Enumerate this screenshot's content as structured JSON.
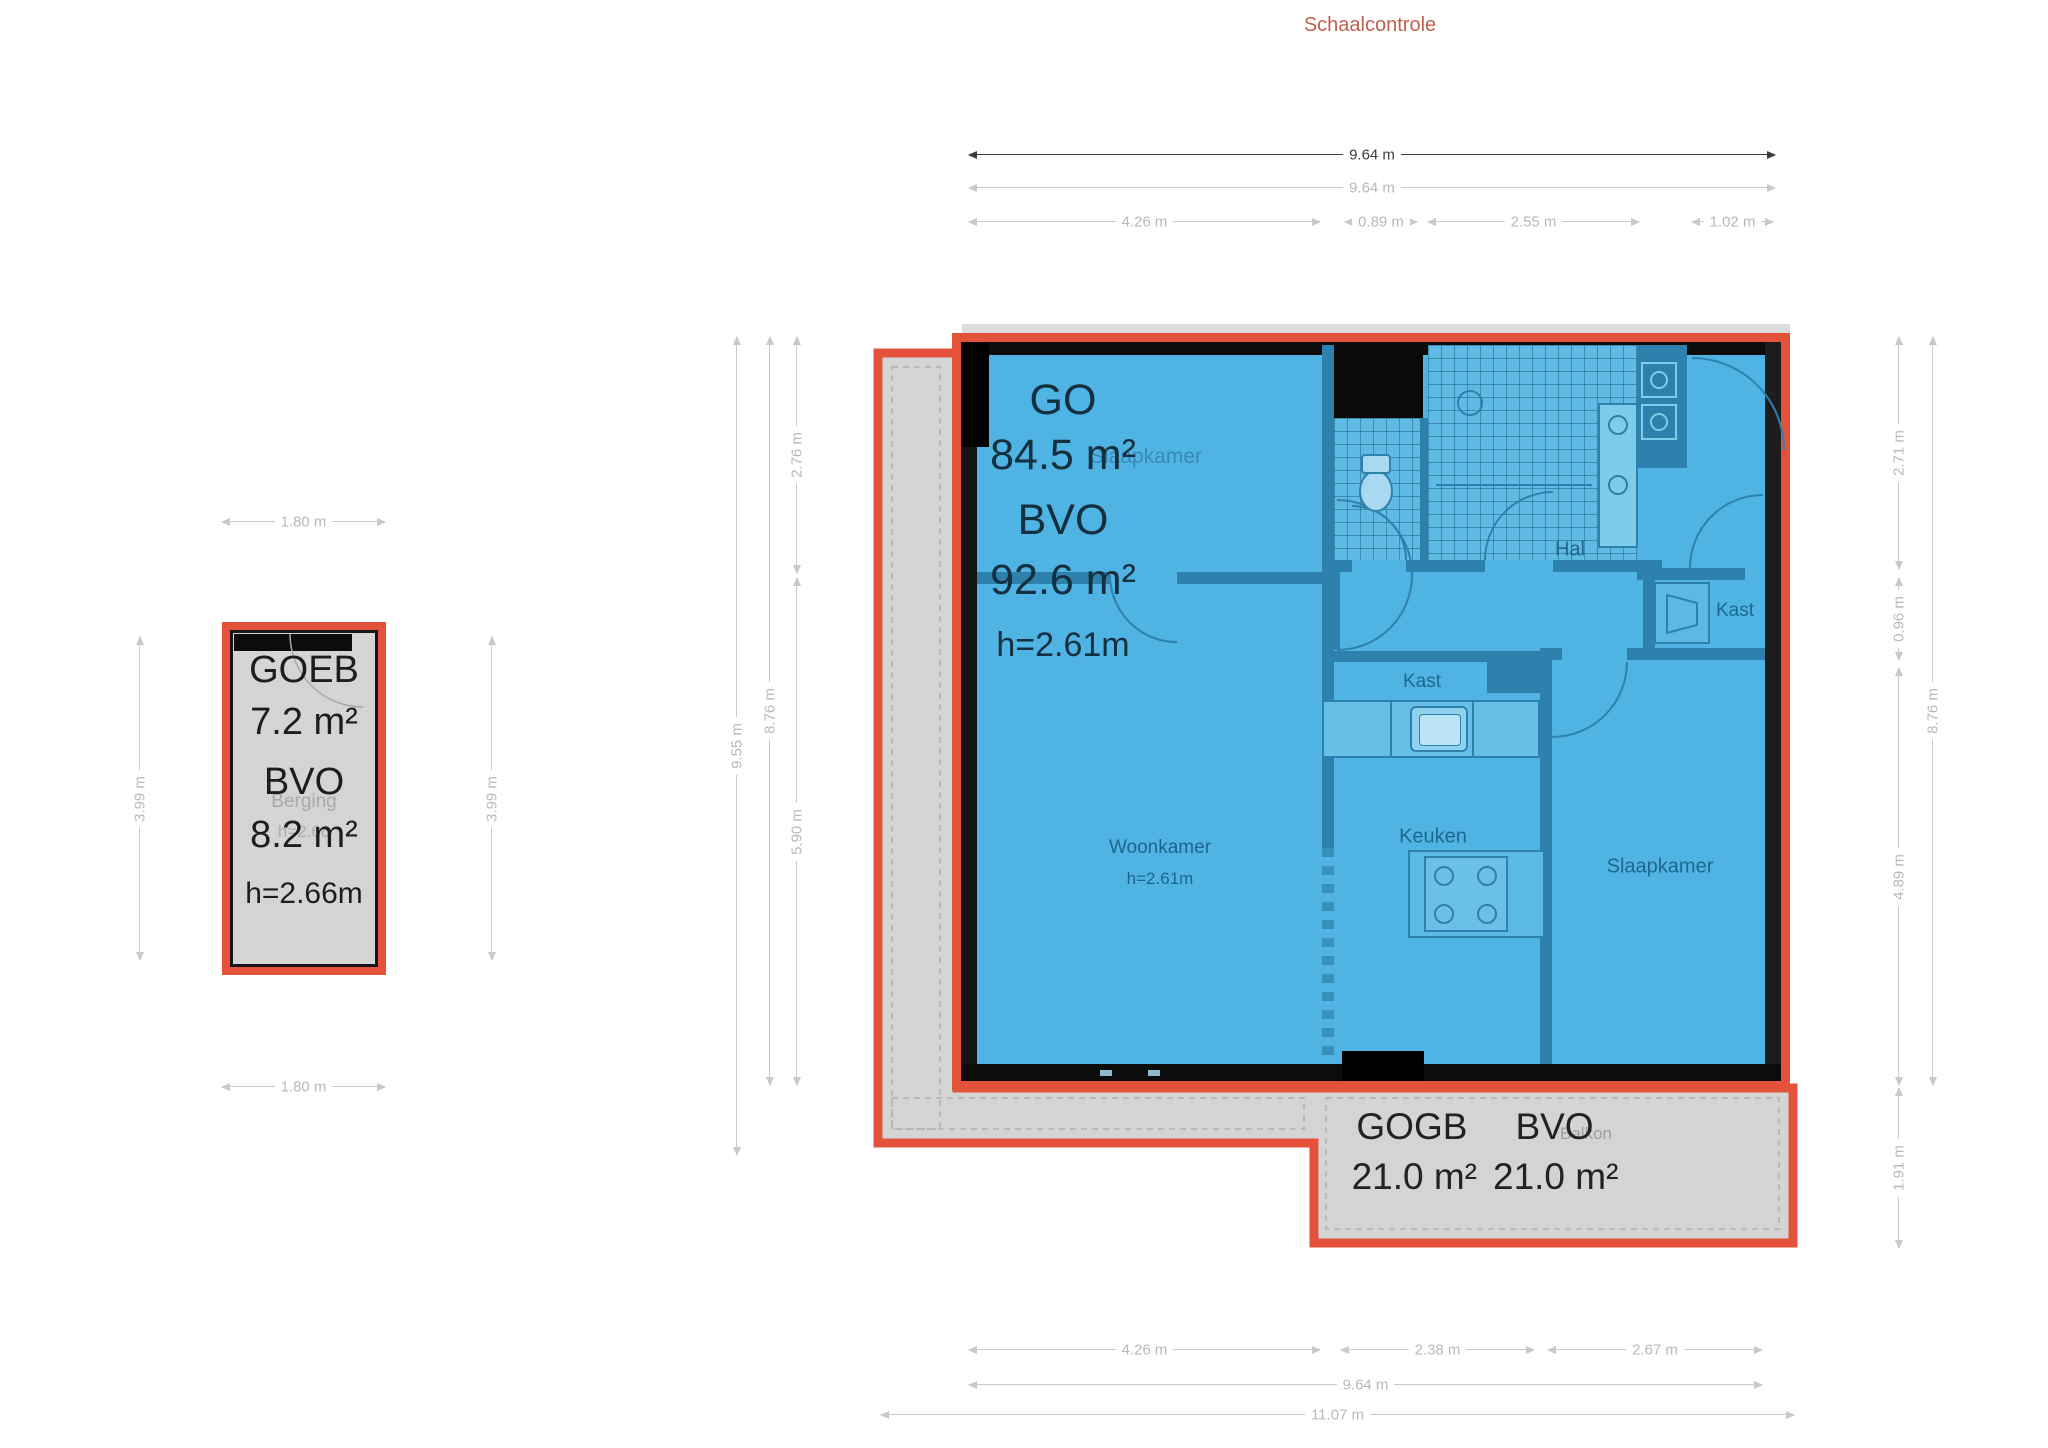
{
  "title": "Schaalcontrole",
  "colors": {
    "accent_red": "#e5523c",
    "plan_blue": "#4fb3e3",
    "wall_dark": "#0c0c0c",
    "wall_blue": "#2e81ac",
    "gray_fill": "#d4d4d4",
    "dim_gray": "#b9b9b9",
    "dim_dark": "#3c3c3c"
  },
  "dims": {
    "top_total_dark": "9.64 m",
    "top_total": "9.64 m",
    "top_seg1": "4.26 m",
    "top_seg2": "0.89 m",
    "top_seg3": "2.55 m",
    "top_seg4": "1.02 m",
    "small_top": "1.80 m",
    "small_left": "3.99 m",
    "small_right": "3.99 m",
    "small_bottom": "1.80 m",
    "main_left_total": "9.55 m",
    "main_left_inner": "8.76 m",
    "main_left_seg1": "2.76 m",
    "main_left_seg2": "5.90 m",
    "main_right_seg1": "2.71 m",
    "main_right_seg2": "0.96 m",
    "main_right_seg3": "4.89 m",
    "main_right_seg4": "1.91 m",
    "main_right_total": "8.76 m",
    "bottom_seg1": "4.26 m",
    "bottom_seg2": "2.38 m",
    "bottom_seg3": "2.67 m",
    "bottom_total": "9.64 m",
    "bottom_overall": "11.07 m"
  },
  "small_building": {
    "code": "GOEB",
    "area": "7.2 m²",
    "bvo_label": "BVO",
    "bvo_area": "8.2 m²",
    "height": "h=2.66m",
    "room_name": "Berging",
    "room_height": "h=2.66"
  },
  "main_building": {
    "go_label": "GO",
    "go_area": "84.5 m²",
    "bvo_label": "BVO",
    "bvo_area": "92.6 m²",
    "height": "h=2.61m",
    "rooms": {
      "bedroom_top": "Slaapkamer",
      "hall": "Hal",
      "closet_right": "Kast",
      "closet_center": "Kast",
      "kitchen": "Keuken",
      "living": "Woonkamer",
      "living_height": "h=2.61m",
      "bedroom_bottom": "Slaapkamer"
    }
  },
  "balcony": {
    "code": "GOGB",
    "bvo_label": "BVO",
    "area": "21.0 m²",
    "bvo_area": "21.0 m²",
    "room_name": "Balkon"
  }
}
